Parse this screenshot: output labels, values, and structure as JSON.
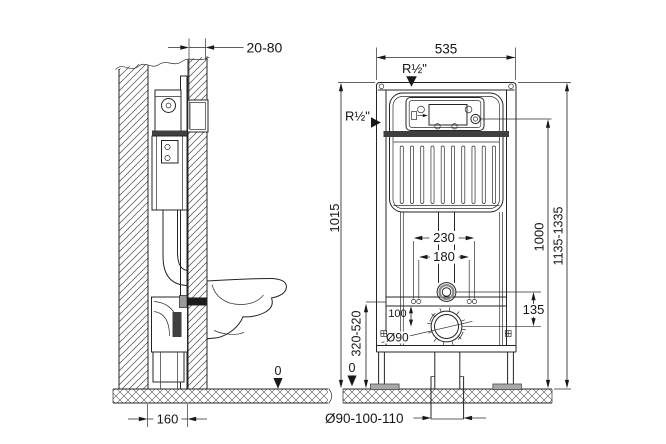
{
  "drawing_type": "installation-frame-technical-drawing",
  "colors": {
    "line": "#242424",
    "text": "#161616",
    "background": "#ffffff",
    "dark_band": "#3f3f3f",
    "foot_gray": "#a8a8a8",
    "ring_gray": "#8a8a8a"
  },
  "side_view": {
    "dims": {
      "wall_clearance": "20-80",
      "frame_depth": "160",
      "floor_level": "0"
    }
  },
  "front_view": {
    "dims": {
      "frame_width": "535",
      "frame_height": "1015",
      "water_connection_top": "R½\"",
      "water_connection_side": "R½\"",
      "fixing_spacing_outer": "230",
      "fixing_spacing_inner": "180",
      "flush_to_outlet": "135",
      "outlet_offset": "100",
      "outlet_height_range": "320-520",
      "outlet_diameter": "Ø90",
      "flush_plate_height": "1000",
      "installation_height": "1135-1335",
      "drain_pipe_sizes": "Ø90-100-110",
      "floor_level": "0"
    }
  }
}
